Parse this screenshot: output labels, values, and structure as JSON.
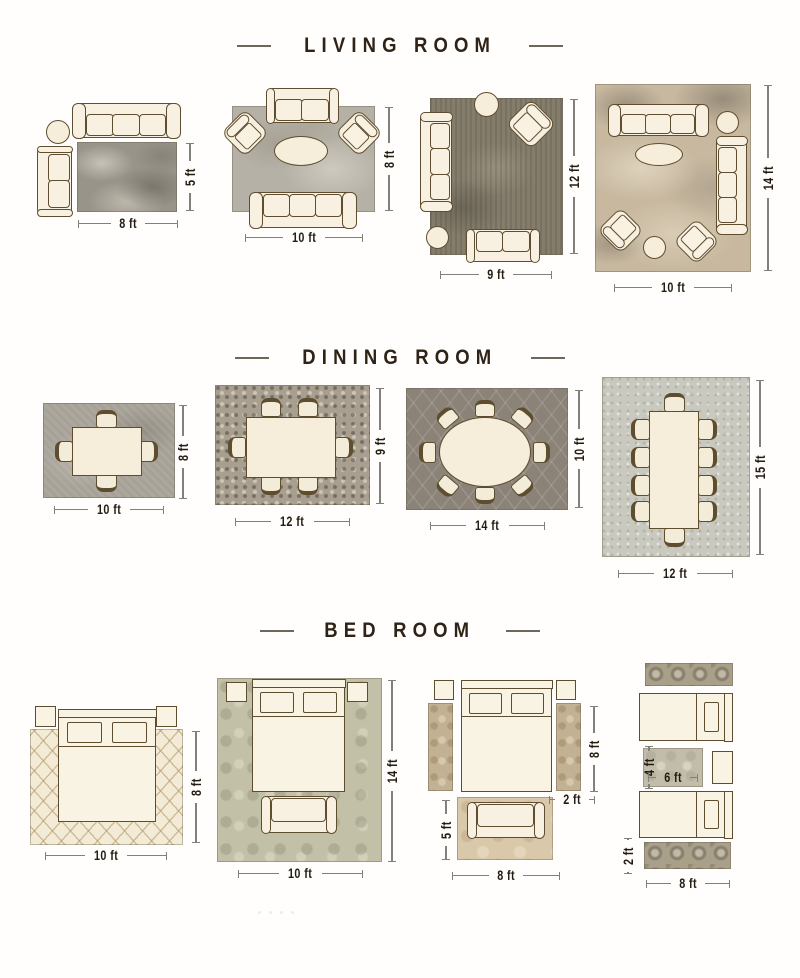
{
  "page": {
    "background": "#fffefc"
  },
  "palette": {
    "title_text": "#2f2216",
    "dimension_text": "#241c10",
    "dimension_line": "#82807a",
    "furniture_fill": "#f8f1e1",
    "furniture_outline": "#5f4d30",
    "rug_gray": "#99948a",
    "rug_cream": "#f3ebd5",
    "rug_sage": "#c3c0a8",
    "rug_tan": "#c3b193"
  },
  "sections": [
    {
      "title": "LIVING ROOM",
      "layouts": [
        {
          "width_label": "8 ft",
          "height_label": "5 ft"
        },
        {
          "width_label": "10 ft",
          "height_label": "8 ft"
        },
        {
          "width_label": "9 ft",
          "height_label": "12 ft"
        },
        {
          "width_label": "10 ft",
          "height_label": "14 ft"
        }
      ]
    },
    {
      "title": "DINING ROOM",
      "layouts": [
        {
          "width_label": "10 ft",
          "height_label": "8 ft"
        },
        {
          "width_label": "12 ft",
          "height_label": "9 ft"
        },
        {
          "width_label": "14 ft",
          "height_label": "10 ft"
        },
        {
          "width_label": "12 ft",
          "height_label": "15 ft"
        }
      ]
    },
    {
      "title": "BED ROOM",
      "layouts": [
        {
          "width_label": "10 ft",
          "height_label": "8 ft"
        },
        {
          "width_label": "10 ft",
          "height_label": "14 ft"
        },
        {
          "side_runner_height_label": "8 ft",
          "side_runner_width_label": "2 ft",
          "foot_rug_height_label": "5 ft",
          "foot_rug_width_label": "8 ft"
        },
        {
          "accent_rug_height_label": "4 ft",
          "accent_rug_width_label": "6 ft",
          "runner_height_label": "2 ft",
          "runner_width_label": "8 ft"
        }
      ]
    }
  ]
}
